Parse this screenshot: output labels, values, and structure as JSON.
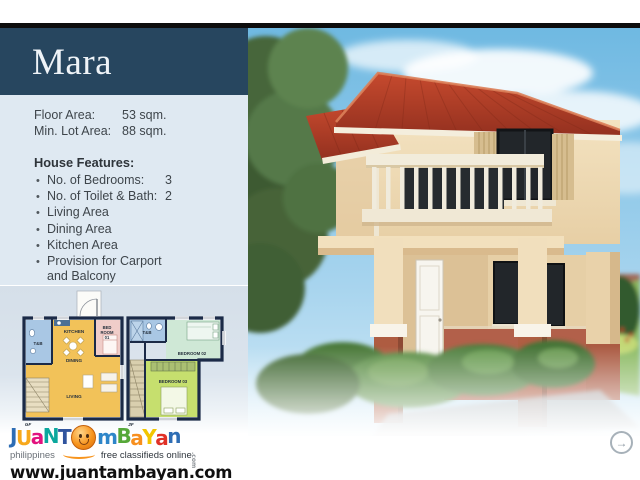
{
  "header": {
    "model_name": "Mara"
  },
  "specs": [
    {
      "label": "Floor Area:",
      "value": "53 sqm."
    },
    {
      "label": "Min. Lot Area:",
      "value": "88 sqm."
    }
  ],
  "features": {
    "heading": "House Features:",
    "items": [
      {
        "label": "No. of Bedrooms:",
        "value": "3"
      },
      {
        "label": "No. of Toilet & Bath:",
        "value": "2"
      },
      {
        "label": "Living Area",
        "value": ""
      },
      {
        "label": "Dining Area",
        "value": ""
      },
      {
        "label": "Kitchen Area",
        "value": ""
      },
      {
        "label": "Provision for Carport and Balcony",
        "value": ""
      }
    ]
  },
  "floor_plans": {
    "ground": {
      "name": "GF",
      "rooms": {
        "toilet": "T&B",
        "kitchen": "KITCHEN",
        "bedroom1_l1": "BED",
        "bedroom1_l2": "ROOM",
        "bedroom1_l3": "01",
        "dining": "DINING",
        "living": "LIVING"
      }
    },
    "second": {
      "name": "2F",
      "rooms": {
        "toilet": "T&B",
        "bedroom2": "BEDROOM 02",
        "bedroom3": "BEDROOM 03"
      }
    }
  },
  "footer": {
    "logo": {
      "part1": [
        "J",
        "U",
        "a",
        "N",
        "T"
      ],
      "part2": [
        "m",
        "B",
        "a",
        "Y",
        "a",
        "n"
      ],
      "suffix": ".com",
      "tagline_left": "philippines",
      "tagline_right": "free classifieds online",
      "url": "www.juantambayan.com"
    },
    "next_button": {
      "glyph": "→"
    }
  },
  "colors": {
    "header_bg": "#27465f",
    "info_panel_bg": "#dfe9f2",
    "plan_panel_bg": "#d7e1ea",
    "top_bar": "#0d0d0d",
    "body_text": "#3e454b",
    "roof_red": "#b13a28",
    "wall_cream": "#f1dfbe",
    "wall_terracotta": "#b2604a",
    "logo_orange": "#f7941d"
  }
}
